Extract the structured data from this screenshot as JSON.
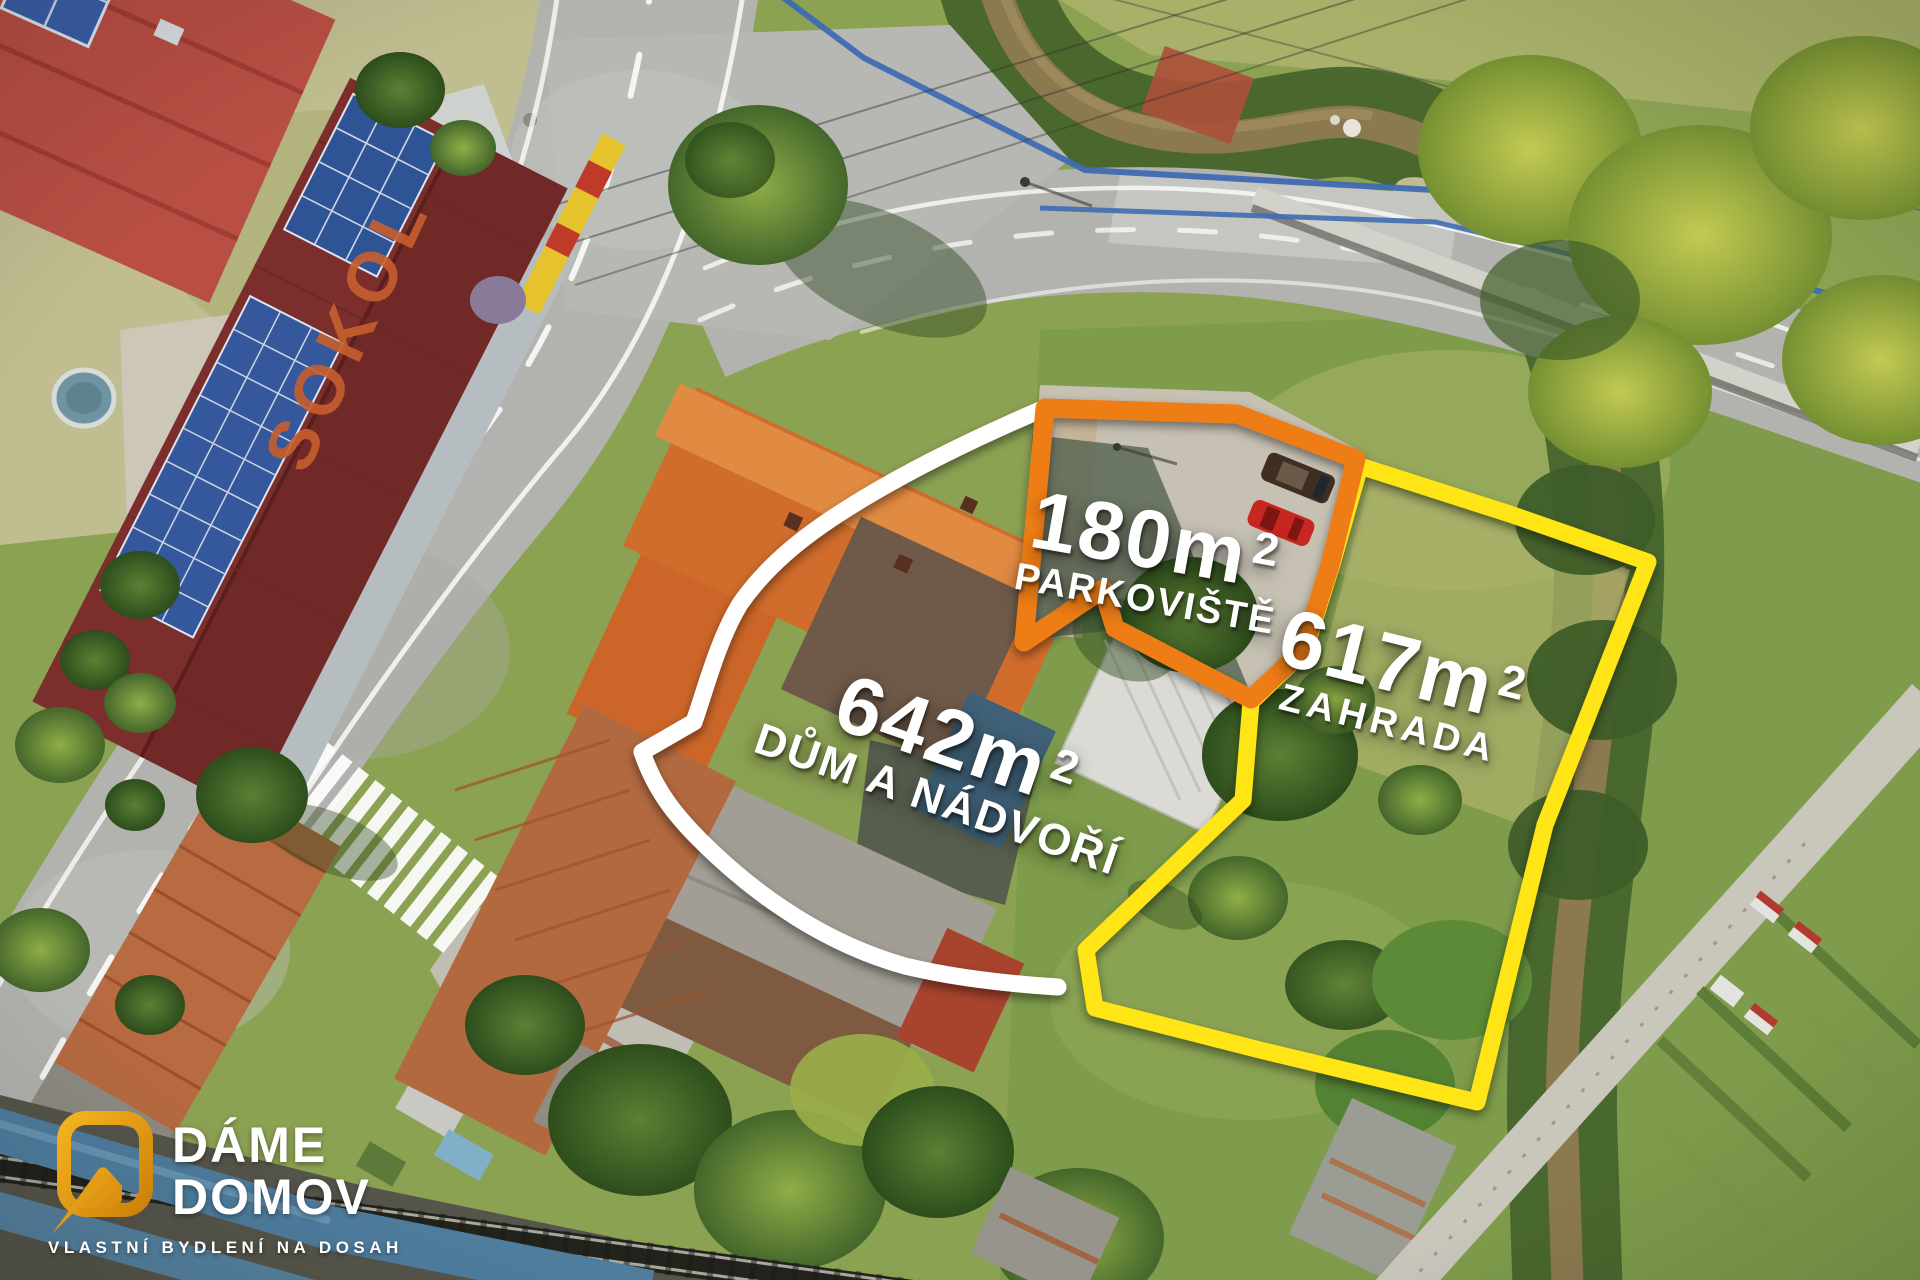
{
  "scene": {
    "type": "aerial-drone-photo",
    "roof_text": "SOKOL",
    "roof_text_color": "#c65f2e"
  },
  "plots": [
    {
      "id": "house-yard",
      "area": "642m",
      "area_sup": "2",
      "label": "DŮM A NÁDVOŘÍ",
      "outline_color": "#ffffff"
    },
    {
      "id": "parking",
      "area": "180m",
      "area_sup": "2",
      "label": "PARKOVIŠTĚ",
      "outline_color": "#ee7d18"
    },
    {
      "id": "garden",
      "area": "617m",
      "area_sup": "2",
      "label": "ZAHRADA",
      "outline_color": "#ffe414"
    }
  ],
  "logo": {
    "name_line1": "DÁME",
    "name_line2": "DOMOV",
    "tagline": "VLASTNÍ BYDLENÍ NA DOSAH",
    "brand_color": "#e8a013",
    "text_color": "#ffffff"
  }
}
